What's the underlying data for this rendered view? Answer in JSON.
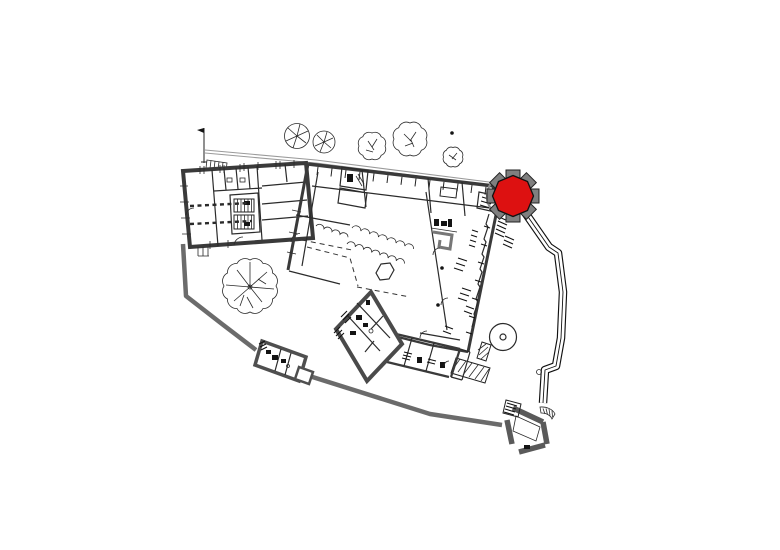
{
  "meta": {
    "description": "Black-and-white architectural site plan (CAD style) of a historic building complex; one octagonal corner tower is highlighted in red",
    "background": "#ffffff",
    "visible_text": ""
  },
  "colors": {
    "background": "#ffffff",
    "ink": "#1a1a1a",
    "wall_dark": "#3a3a3a",
    "wall_gray": "#6b6b6b",
    "gate_gray": "#5a5a5a",
    "fence_gray": "#9a9a9a",
    "buttress_gray": "#7f7f7f",
    "highlight_red": "#dd1111",
    "hatch_ink": "#111111",
    "white": "#ffffff"
  },
  "elements": {
    "highlighted_tower": {
      "shape": "octagonal tower with corner buttresses",
      "state": "highlighted",
      "color": "#dd1111"
    },
    "buildings": [
      "west-manor-wing",
      "abbey-main-complex",
      "southwest-room-cluster",
      "south-range-rooms",
      "boundary-outbuilding",
      "southeast-gatehouse"
    ],
    "site_features": [
      "perimeter-boundary-wall",
      "access-path-to-tower",
      "courtyard-fountain-hexagon",
      "round-turret-base",
      "terrace-hatched-steps",
      "cloister-arcade",
      "trees",
      "flag-pole-and-fence"
    ]
  }
}
